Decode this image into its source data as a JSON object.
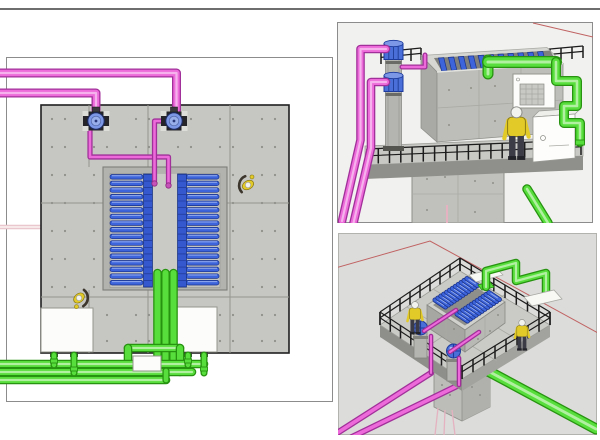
{
  "colors": {
    "background": "#ffffff",
    "top_rule": "#6e6e6e",
    "panel_border": "#8c8c8c",
    "panel_bg_upper": "#f1f1ef",
    "panel_bg_lower": "#dcdcda",
    "concrete": "#c6c6c2",
    "concrete_joint": "#96968f",
    "basin": "#b2b2ae",
    "basin_floor": "#c2c2be",
    "channel": "#c9c9c5",
    "bar_blue": "#3d64da",
    "bar_blue_dark": "#1b338a",
    "bar_blue_light": "#93abee",
    "pipe_magenta": "#ec6ad9",
    "pipe_magenta_dark": "#a1309a",
    "pipe_green": "#58de3c",
    "pipe_green_dark": "#279310",
    "cabinet_white": "#fcfcfa",
    "cabinet_border": "#96968f",
    "railing_black": "#1c1c1c",
    "worker_yellow": "#e2ca28",
    "worker_dark": "#3c3c46",
    "helmet_white": "#f2f2ee",
    "pump_blue": "#7b97e6",
    "pump_base": "#26262a",
    "cylinder_gray": "#b4b4b0",
    "cylinder_cap_blue": "#4a6fd8",
    "axis_red": "#c06262",
    "axis_pink": "#e4b2c0"
  },
  "panels": {
    "plan_view": {
      "pumps": 2,
      "magenta_supply_pipes": 2,
      "green_drain_risers": 3,
      "green_manifold_lines": 3,
      "clarifier": {
        "banks": 2,
        "bars_per_bank": 17
      },
      "cabinets": 2,
      "workers": 2
    },
    "iso_view_upper": {
      "plates": 11,
      "chemical_cylinders": 2,
      "cabinets": 2,
      "workers": 1,
      "railing_sections": 3
    },
    "iso_view_lower": {
      "banks": 2,
      "slats_per_bank": 12,
      "pump_cylinders": 2,
      "white_boxes": 2,
      "workers": 2,
      "railing_sections": 4
    }
  }
}
